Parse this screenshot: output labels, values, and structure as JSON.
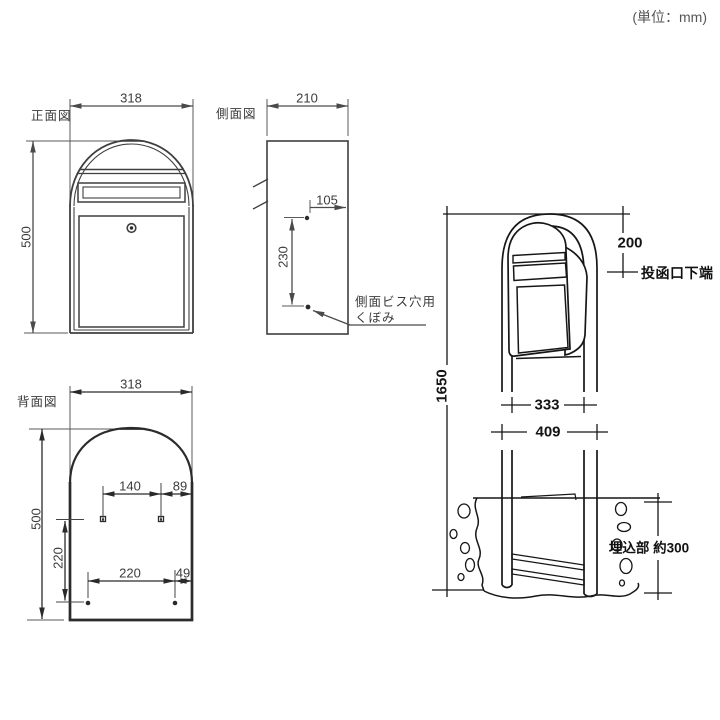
{
  "unit_note": "(単位：mm)",
  "front_view": {
    "label": "正面図",
    "width": "318",
    "height": "500"
  },
  "side_view": {
    "label": "側面図",
    "width": "210",
    "hole_inset": "105",
    "hole_pitch": "230",
    "note_line1": "側面ビス穴用",
    "note_line2": "くぼみ"
  },
  "rear_view": {
    "label": "背面図",
    "width": "318",
    "height": "500",
    "upper_hole_pitch": "140",
    "upper_hole_edge": "89",
    "row_pitch": "220",
    "lower_hole_pitch": "220",
    "lower_hole_edge": "49"
  },
  "installed_view": {
    "slot_top_offset": "200",
    "slot_label": "投函口下端",
    "pole_length": "1650",
    "inner_width": "333",
    "outer_width": "409",
    "embed_note": "埋込部 約300"
  }
}
